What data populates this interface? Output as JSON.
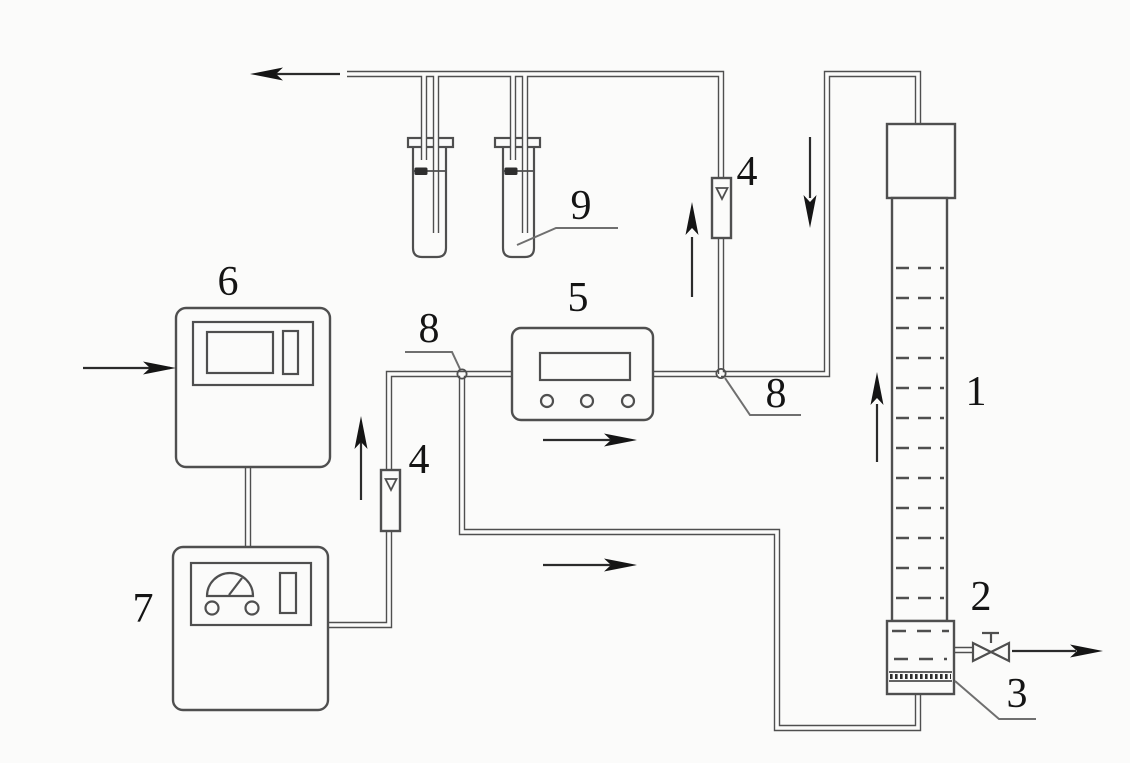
{
  "canvas": {
    "width": 1130,
    "height": 763,
    "background": "#fbfbfa"
  },
  "colors": {
    "bg": "#fbfbfa",
    "line": "#4f4f4f",
    "arrowline": "#2b2b2b",
    "arrowhead": "#151515",
    "leader": "#6f6f6f",
    "label": "#141414"
  },
  "labels": {
    "l1": "1",
    "l2": "2",
    "l3": "3",
    "l4a": "4",
    "l4b": "4",
    "l5": "5",
    "l6": "6",
    "l7": "7",
    "l8a": "8",
    "l8b": "8",
    "l9": "9"
  }
}
